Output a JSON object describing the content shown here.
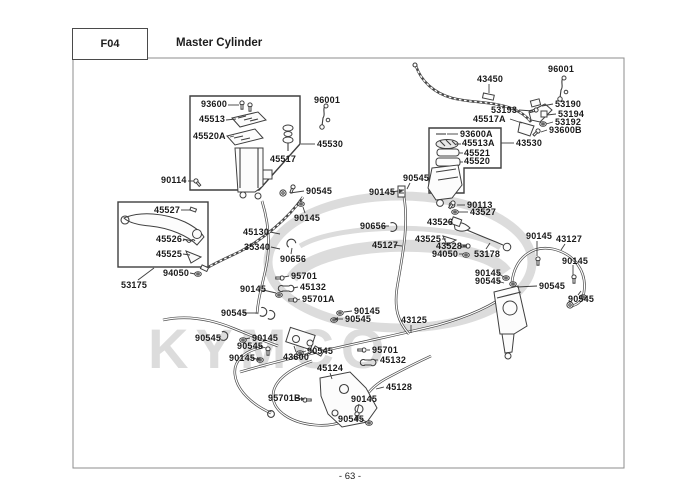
{
  "header": {
    "code": "F04",
    "title": "Master Cylinder"
  },
  "footer": {
    "page_number": "- 63 -"
  },
  "watermark": {
    "text": "KYMCO"
  },
  "colors": {
    "ink": "#3f3f3f",
    "watermark": "#dcdcdc"
  },
  "diagram": {
    "labels": [
      {
        "text": "43450",
        "x": 477,
        "y": 75
      },
      {
        "text": "96001",
        "x": 548,
        "y": 65
      },
      {
        "text": "53190",
        "x": 555,
        "y": 100
      },
      {
        "text": "53193",
        "x": 491,
        "y": 106
      },
      {
        "text": "53194",
        "x": 558,
        "y": 110
      },
      {
        "text": "45517A",
        "x": 473,
        "y": 115
      },
      {
        "text": "53192",
        "x": 555,
        "y": 118
      },
      {
        "text": "93600B",
        "x": 549,
        "y": 126
      },
      {
        "text": "43530",
        "x": 516,
        "y": 139
      },
      {
        "text": "93600A",
        "x": 460,
        "y": 130
      },
      {
        "text": "45513A",
        "x": 462,
        "y": 139
      },
      {
        "text": "45521",
        "x": 464,
        "y": 149
      },
      {
        "text": "45520",
        "x": 464,
        "y": 157
      },
      {
        "text": "90113",
        "x": 467,
        "y": 201
      },
      {
        "text": "43527",
        "x": 470,
        "y": 208
      },
      {
        "text": "43526",
        "x": 427,
        "y": 218
      },
      {
        "text": "43525",
        "x": 415,
        "y": 235
      },
      {
        "text": "43528",
        "x": 436,
        "y": 242
      },
      {
        "text": "94050",
        "x": 432,
        "y": 250
      },
      {
        "text": "53178",
        "x": 474,
        "y": 250
      },
      {
        "text": "93600",
        "x": 201,
        "y": 100
      },
      {
        "text": "45513",
        "x": 199,
        "y": 115
      },
      {
        "text": "45520A",
        "x": 193,
        "y": 132
      },
      {
        "text": "45517",
        "x": 270,
        "y": 155
      },
      {
        "text": "45530",
        "x": 317,
        "y": 140
      },
      {
        "text": "96001",
        "x": 314,
        "y": 96
      },
      {
        "text": "90114",
        "x": 161,
        "y": 176
      },
      {
        "text": "45527",
        "x": 154,
        "y": 206
      },
      {
        "text": "45526",
        "x": 156,
        "y": 235
      },
      {
        "text": "45525",
        "x": 156,
        "y": 250
      },
      {
        "text": "94050",
        "x": 163,
        "y": 269
      },
      {
        "text": "53175",
        "x": 121,
        "y": 281
      },
      {
        "text": "45130",
        "x": 243,
        "y": 228
      },
      {
        "text": "35340",
        "x": 244,
        "y": 243
      },
      {
        "text": "90545",
        "x": 306,
        "y": 187
      },
      {
        "text": "90145",
        "x": 294,
        "y": 214
      },
      {
        "text": "90656",
        "x": 280,
        "y": 255
      },
      {
        "text": "95701",
        "x": 291,
        "y": 272
      },
      {
        "text": "45132",
        "x": 300,
        "y": 283
      },
      {
        "text": "95701A",
        "x": 302,
        "y": 295
      },
      {
        "text": "90145",
        "x": 240,
        "y": 285
      },
      {
        "text": "90545",
        "x": 221,
        "y": 309
      },
      {
        "text": "90145",
        "x": 369,
        "y": 188
      },
      {
        "text": "90545",
        "x": 403,
        "y": 174
      },
      {
        "text": "90656",
        "x": 360,
        "y": 222
      },
      {
        "text": "45127",
        "x": 372,
        "y": 241
      },
      {
        "text": "90145",
        "x": 354,
        "y": 307
      },
      {
        "text": "90545",
        "x": 345,
        "y": 315
      },
      {
        "text": "90545",
        "x": 195,
        "y": 334
      },
      {
        "text": "90145",
        "x": 252,
        "y": 334
      },
      {
        "text": "90545",
        "x": 237,
        "y": 342
      },
      {
        "text": "90145",
        "x": 229,
        "y": 354
      },
      {
        "text": "43600",
        "x": 283,
        "y": 353
      },
      {
        "text": "90545",
        "x": 307,
        "y": 347
      },
      {
        "text": "45124",
        "x": 317,
        "y": 364
      },
      {
        "text": "95701B",
        "x": 268,
        "y": 394
      },
      {
        "text": "45128",
        "x": 386,
        "y": 383
      },
      {
        "text": "90145",
        "x": 351,
        "y": 395
      },
      {
        "text": "90545",
        "x": 338,
        "y": 415
      },
      {
        "text": "43125",
        "x": 401,
        "y": 316
      },
      {
        "text": "95701",
        "x": 372,
        "y": 346
      },
      {
        "text": "45132",
        "x": 380,
        "y": 356
      },
      {
        "text": "90145",
        "x": 475,
        "y": 269
      },
      {
        "text": "90545",
        "x": 475,
        "y": 277
      },
      {
        "text": "90545",
        "x": 539,
        "y": 282
      },
      {
        "text": "90145",
        "x": 526,
        "y": 232
      },
      {
        "text": "43127",
        "x": 556,
        "y": 235
      },
      {
        "text": "90145",
        "x": 562,
        "y": 257
      },
      {
        "text": "90545",
        "x": 568,
        "y": 295
      }
    ]
  }
}
